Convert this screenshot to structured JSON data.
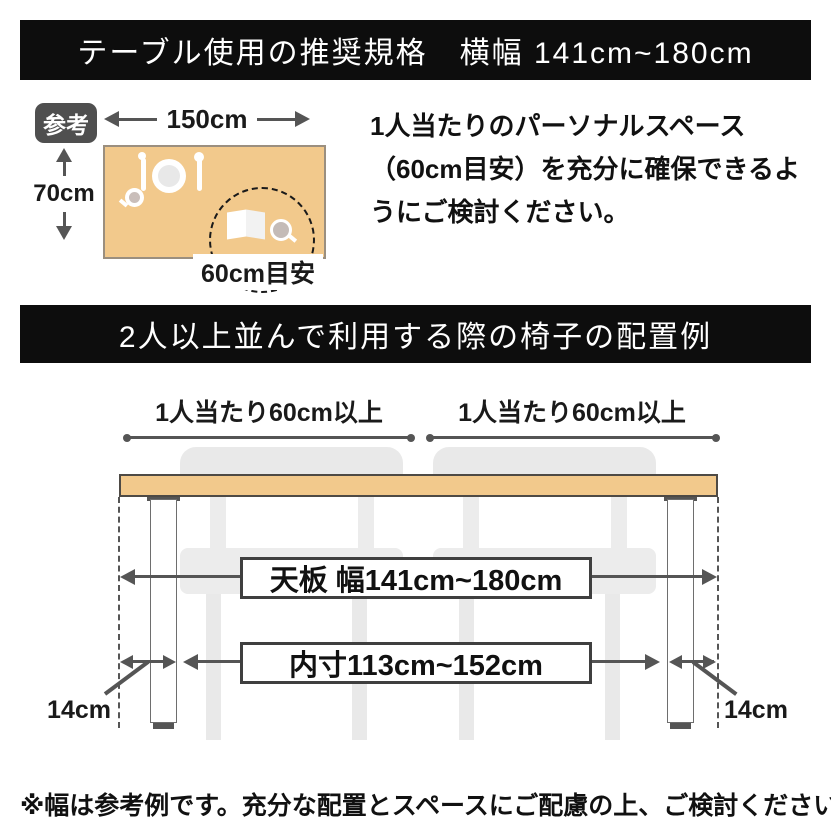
{
  "colors": {
    "banner_bg": "#0d0d0d",
    "banner_text": "#ffffff",
    "tabletop_fill": "#f2c98c",
    "tabletop_border": "#4e4a45",
    "line": "#555555",
    "chair_gray": "#e9e9e9",
    "box_border": "#3f3f3f",
    "badge_bg": "#4f4f4f"
  },
  "banner_top": {
    "title": "テーブル使用の推奨規格　横幅 141cm~180cm"
  },
  "reference_section": {
    "badge_label": "参考",
    "table_width_label": "150cm",
    "table_depth_label": "70cm",
    "personal_space_label": "60cm目安",
    "note": "1人当たりのパーソナルスペース（60cm目安）を充分に確保できるようにご検討ください。"
  },
  "banner_chairs": {
    "title": "2人以上並んで利用する際の椅子の配置例"
  },
  "chair_layout": {
    "per_person_left_label": "1人当たり60cm以上",
    "per_person_right_label": "1人当たり60cm以上",
    "tabletop_width_label": "天板 幅141cm~180cm",
    "inner_width_label": "内寸113cm~152cm",
    "leg_inset_left_label": "14cm",
    "leg_inset_right_label": "14cm"
  },
  "footnote": {
    "text": "※幅は参考例です。充分な配置とスペースにご配慮の上、ご検討ください。"
  }
}
